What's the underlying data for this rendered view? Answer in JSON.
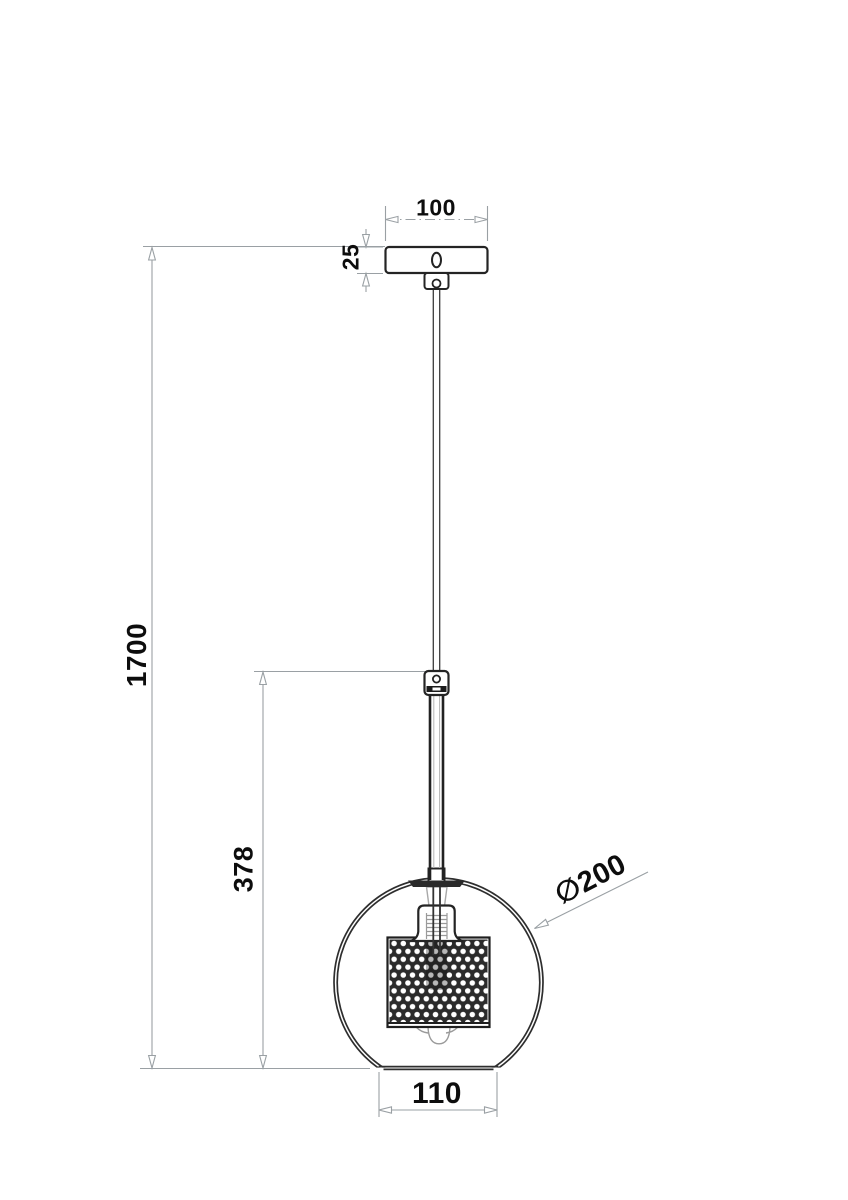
{
  "drawing": {
    "title": "Pendant lamp dimensional drawing",
    "labels": {
      "canopy_width": "100",
      "canopy_height": "25",
      "overall_height": "1700",
      "rod_length": "378",
      "opening_width": "110",
      "shade_diameter": "∅200"
    },
    "colors": {
      "outline_dark": "#242424",
      "inner_gray": "#9a9a9a",
      "dimension_gray": "#9aa0a4",
      "label_text": "#0d0d0d",
      "background": "#ffffff"
    }
  }
}
